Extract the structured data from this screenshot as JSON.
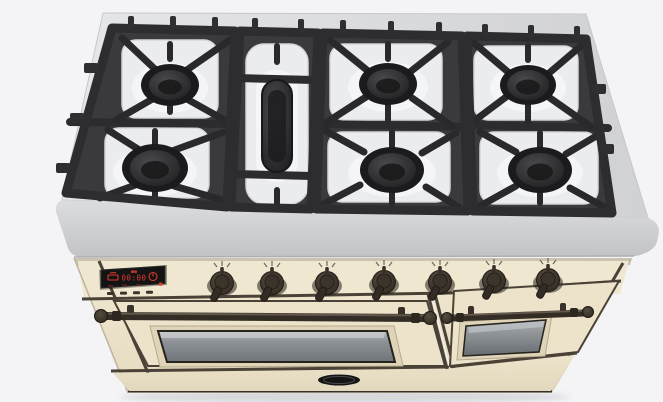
{
  "scene": {
    "type": "3d-product-render",
    "subject": "dual-fuel-range-cooker",
    "view": "front-top-perspective"
  },
  "theme": {
    "bg": "#f4f4f7",
    "steel": "#d5d6d9",
    "grate": "#2d2d2f",
    "enamel": "#ebeced",
    "cream": "#ece2c9",
    "cream-light": "#f0e7d0",
    "cream-dark": "#ddd3b8",
    "trim": "#4a4236",
    "metal": "#39322a",
    "metal-light": "#6e6356",
    "display-bg": "#141414",
    "display-red": "#e03a2c"
  },
  "cooktop": {
    "round_burner_count": 6,
    "oval_burner_count": 1,
    "grate_section_count": 4,
    "surface_finish": "stainless"
  },
  "display": {
    "time": "00:00",
    "left_icon": "pot-icon",
    "right_icon": "timer-icon"
  },
  "controls": {
    "knob_count": 7
  },
  "ovens": {
    "door_count": 2
  },
  "drawer": {
    "badge": "brand-badge-oval"
  }
}
